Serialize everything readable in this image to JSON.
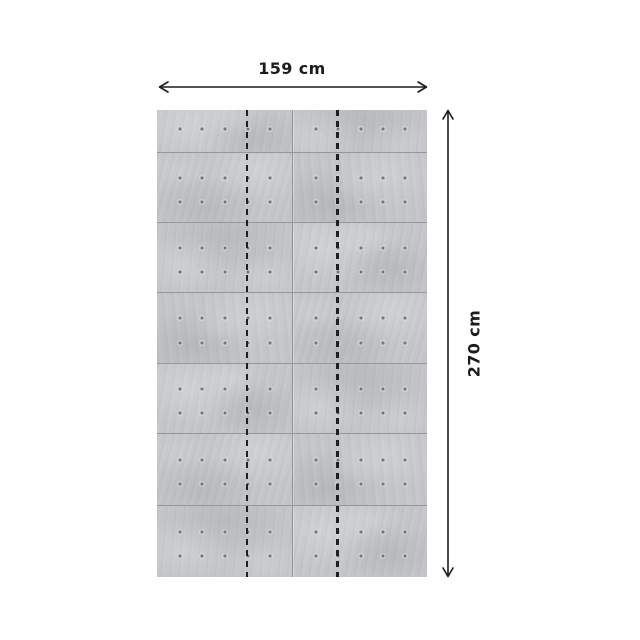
{
  "diagram": {
    "width_label": "159 cm",
    "height_label": "270 cm",
    "text_color": "#1c1c1c",
    "background_color": "#ffffff",
    "panel": {
      "material": "concrete-block-mural",
      "base_color": "#c3c5c7",
      "seam_color": "#95979a",
      "strip_divider_color": "#1f1f1f",
      "tie_hole_color": "#74767a",
      "rows": 7,
      "columns": 2,
      "strips": 3,
      "row_heights_px": [
        42,
        70,
        70,
        71,
        70,
        72,
        72
      ],
      "dot_cols_pct": [
        17.2,
        33.6,
        50.4,
        67.2,
        83.6
      ],
      "dot_rows_full_pct": [
        36,
        71
      ],
      "dot_rows_short_pct": [
        46
      ],
      "strip_divider_x_pct": [
        33.33,
        66.67
      ]
    }
  }
}
